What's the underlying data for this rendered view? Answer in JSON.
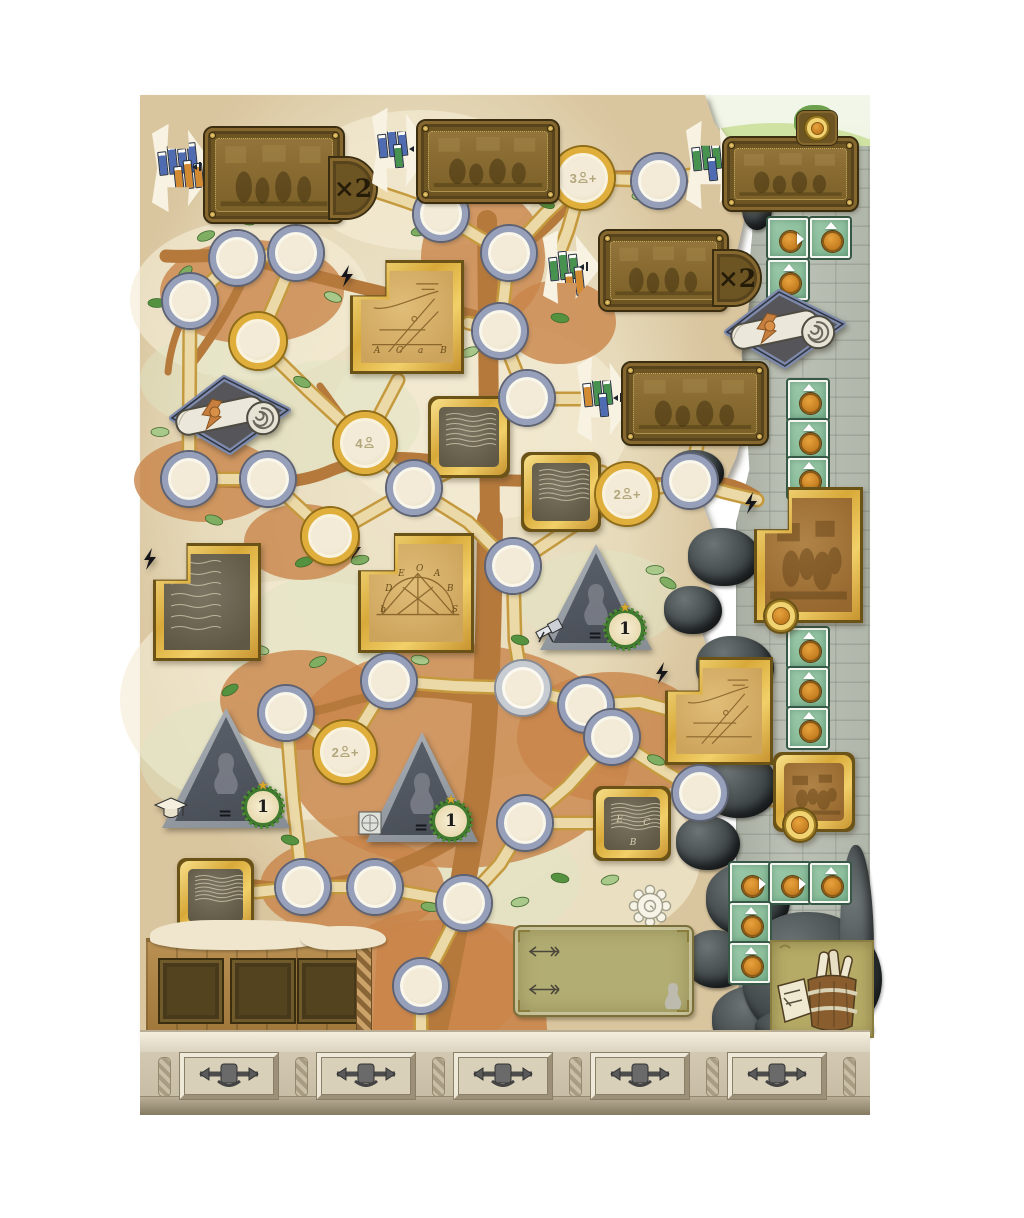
{
  "palette": {
    "parchment": "#e9dfc3",
    "path_fill": "#ecd9a8",
    "path_edge": "#c59a3f",
    "branch": "#b5793c",
    "dirt": "#c9854a",
    "node_rim_blue": "#97a0ba",
    "node_rim_gold": "#e0ae3b",
    "track_green": "#8cc19e",
    "coin_orange": "#d08a2e",
    "book_blue": "#4f6cb2",
    "book_orange": "#d28a33",
    "book_green": "#46924e",
    "plaque_brown": "#6d5423",
    "stone_light": "#b5bab0",
    "stone_dark": "#33393b",
    "triangle_gray": "#9aa0a6",
    "badge_green": "#3f7a2e"
  },
  "banners": [
    {
      "name": "bookshop-banner-1",
      "flag": {
        "x": 152,
        "y": 120,
        "w": 64,
        "h": 96
      },
      "stacks": [
        [
          "blue",
          "blue",
          "blue",
          "blue"
        ],
        [
          "orange",
          "orange",
          "orange"
        ]
      ],
      "plaque": {
        "x": 205,
        "y": 128,
        "w": 132,
        "h": 88
      },
      "multiplier": "×2",
      "mult_box": {
        "x": 330,
        "y": 158,
        "w": 40,
        "h": 54
      }
    },
    {
      "name": "bookshop-banner-2",
      "flag": {
        "x": 372,
        "y": 104,
        "w": 60,
        "h": 92
      },
      "stacks": [
        [
          "blue",
          "blue",
          "blue"
        ],
        [
          "green"
        ]
      ],
      "plaque": {
        "x": 418,
        "y": 121,
        "w": 134,
        "h": 75
      }
    },
    {
      "name": "bookshop-banner-3",
      "flag": {
        "x": 686,
        "y": 117,
        "w": 60,
        "h": 96
      },
      "stacks": [
        [
          "green",
          "green",
          "green"
        ],
        [
          "blue"
        ]
      ],
      "plaque": {
        "x": 724,
        "y": 138,
        "w": 127,
        "h": 66
      },
      "top_medallion": {
        "x": 797,
        "y": 111,
        "w": 36,
        "h": 30
      }
    },
    {
      "name": "bookshop-banner-4",
      "flag": {
        "x": 543,
        "y": 227,
        "w": 58,
        "h": 80
      },
      "stacks": [
        [
          "green",
          "green",
          "green"
        ],
        [
          "orange",
          "orange"
        ]
      ],
      "plaque": {
        "x": 600,
        "y": 231,
        "w": 121,
        "h": 73
      },
      "multiplier": "×2",
      "mult_box": {
        "x": 714,
        "y": 251,
        "w": 40,
        "h": 48
      }
    },
    {
      "name": "bookshop-banner-5",
      "flag": {
        "x": 577,
        "y": 353,
        "w": 58,
        "h": 92
      },
      "stacks": [
        [
          "orange",
          "green",
          "green"
        ],
        [
          "blue"
        ]
      ],
      "plaque": {
        "x": 623,
        "y": 363,
        "w": 138,
        "h": 75
      }
    }
  ],
  "nodes": [
    {
      "x": 441,
      "y": 214,
      "rim": "blue",
      "count": "",
      "suffix": ""
    },
    {
      "x": 509,
      "y": 253,
      "rim": "blue",
      "count": "",
      "suffix": ""
    },
    {
      "x": 583,
      "y": 178,
      "rim": "gold",
      "count": "3",
      "suffix": "+"
    },
    {
      "x": 659,
      "y": 181,
      "rim": "blue",
      "count": "",
      "suffix": ""
    },
    {
      "x": 237,
      "y": 258,
      "rim": "blue",
      "count": "",
      "suffix": ""
    },
    {
      "x": 296,
      "y": 253,
      "rim": "blue",
      "count": "",
      "suffix": ""
    },
    {
      "x": 190,
      "y": 301,
      "rim": "blue",
      "count": "",
      "suffix": ""
    },
    {
      "x": 258,
      "y": 341,
      "rim": "gold",
      "count": "",
      "suffix": ""
    },
    {
      "x": 500,
      "y": 331,
      "rim": "blue",
      "count": "",
      "suffix": ""
    },
    {
      "x": 527,
      "y": 398,
      "rim": "blue",
      "count": "",
      "suffix": ""
    },
    {
      "x": 365,
      "y": 443,
      "rim": "gold",
      "count": "4",
      "suffix": ""
    },
    {
      "x": 189,
      "y": 479,
      "rim": "blue",
      "count": "",
      "suffix": ""
    },
    {
      "x": 268,
      "y": 479,
      "rim": "blue",
      "count": "",
      "suffix": ""
    },
    {
      "x": 414,
      "y": 488,
      "rim": "blue",
      "count": "",
      "suffix": ""
    },
    {
      "x": 627,
      "y": 494,
      "rim": "gold",
      "count": "2",
      "suffix": "+"
    },
    {
      "x": 690,
      "y": 481,
      "rim": "blue",
      "count": "",
      "suffix": ""
    },
    {
      "x": 330,
      "y": 536,
      "rim": "gold",
      "count": "",
      "suffix": ""
    },
    {
      "x": 513,
      "y": 566,
      "rim": "blue",
      "count": "",
      "suffix": ""
    },
    {
      "x": 286,
      "y": 713,
      "rim": "blue",
      "count": "",
      "suffix": ""
    },
    {
      "x": 389,
      "y": 681,
      "rim": "blue",
      "count": "",
      "suffix": ""
    },
    {
      "x": 523,
      "y": 688,
      "rim": "silver",
      "count": "",
      "suffix": ""
    },
    {
      "x": 586,
      "y": 705,
      "rim": "blue",
      "count": "",
      "suffix": ""
    },
    {
      "x": 612,
      "y": 737,
      "rim": "blue",
      "count": "",
      "suffix": ""
    },
    {
      "x": 345,
      "y": 752,
      "rim": "gold",
      "count": "2",
      "suffix": "+"
    },
    {
      "x": 700,
      "y": 793,
      "rim": "blue",
      "count": "",
      "suffix": ""
    },
    {
      "x": 525,
      "y": 823,
      "rim": "blue",
      "count": "",
      "suffix": ""
    },
    {
      "x": 303,
      "y": 887,
      "rim": "blue",
      "count": "",
      "suffix": ""
    },
    {
      "x": 375,
      "y": 887,
      "rim": "blue",
      "count": "",
      "suffix": ""
    },
    {
      "x": 464,
      "y": 903,
      "rim": "blue",
      "count": "",
      "suffix": ""
    },
    {
      "x": 421,
      "y": 986,
      "rim": "blue",
      "count": "",
      "suffix": ""
    }
  ],
  "tiles": [
    {
      "kind": "sketch",
      "x": 353,
      "y": 263,
      "w": 108,
      "h": 108,
      "notch": true,
      "bolt": true,
      "letters": [
        "A",
        "C",
        "a",
        "B"
      ],
      "layout": "row"
    },
    {
      "kind": "sketch",
      "x": 361,
      "y": 536,
      "w": 110,
      "h": 114,
      "notch": true,
      "bolt": true,
      "letters": [
        "b",
        "D",
        "E",
        "O",
        "A",
        "B",
        "S"
      ],
      "layout": "arc"
    },
    {
      "kind": "manuscript",
      "x": 156,
      "y": 546,
      "w": 102,
      "h": 112,
      "notch": true,
      "bolt": true,
      "letters": [],
      "layout": "row"
    },
    {
      "kind": "manuscript",
      "x": 431,
      "y": 399,
      "w": 76,
      "h": 76,
      "letters": [],
      "layout": "row"
    },
    {
      "kind": "manuscript",
      "x": 524,
      "y": 455,
      "w": 74,
      "h": 74,
      "letters": [],
      "layout": "row"
    },
    {
      "kind": "manuscript",
      "x": 596,
      "y": 789,
      "w": 72,
      "h": 69,
      "letters": [
        "E",
        "C",
        "B"
      ],
      "layout": "scatter"
    },
    {
      "kind": "manuscript",
      "x": 180,
      "y": 861,
      "w": 71,
      "h": 69,
      "letters": [],
      "layout": "row"
    },
    {
      "kind": "sketch",
      "x": 668,
      "y": 660,
      "w": 102,
      "h": 102,
      "notch": true,
      "bolt": true,
      "letters": [],
      "layout": "row"
    },
    {
      "kind": "engraving",
      "x": 757,
      "y": 490,
      "w": 103,
      "h": 130,
      "notch": true,
      "bolt": true,
      "coin": true,
      "letters": [],
      "layout": "row"
    },
    {
      "kind": "engraving",
      "x": 776,
      "y": 755,
      "w": 76,
      "h": 74,
      "coin": true,
      "letters": [],
      "layout": "row"
    }
  ],
  "scrolls": [
    {
      "x": 163,
      "y": 368,
      "w": 132,
      "h": 92
    },
    {
      "x": 718,
      "y": 282,
      "w": 132,
      "h": 92
    }
  ],
  "triangles": [
    {
      "x": 162,
      "y": 708,
      "w": 128,
      "h": 120,
      "icon": "mortarboard-icon",
      "equals": "=",
      "badge": "1"
    },
    {
      "x": 366,
      "y": 732,
      "w": 112,
      "h": 110,
      "icon": "seal-icon",
      "equals": "=",
      "badge": "1"
    },
    {
      "x": 540,
      "y": 544,
      "w": 112,
      "h": 106,
      "icon": "telescope-icon",
      "equals": "=",
      "badge": "1"
    }
  ],
  "track": {
    "coin_icon": "coin-icon",
    "tiles": [
      {
        "x": 768,
        "y": 218,
        "arrow": "right"
      },
      {
        "x": 810,
        "y": 218,
        "arrow": "up"
      },
      {
        "x": 768,
        "y": 260,
        "arrow": "up"
      },
      {
        "x": 788,
        "y": 380,
        "arrow": "up"
      },
      {
        "x": 788,
        "y": 420,
        "arrow": "up"
      },
      {
        "x": 788,
        "y": 458,
        "arrow": "up"
      },
      {
        "x": 788,
        "y": 628,
        "arrow": "up"
      },
      {
        "x": 788,
        "y": 668,
        "arrow": "up"
      },
      {
        "x": 788,
        "y": 708,
        "arrow": "up"
      },
      {
        "x": 730,
        "y": 863,
        "arrow": "right"
      },
      {
        "x": 770,
        "y": 863,
        "arrow": "right"
      },
      {
        "x": 810,
        "y": 863,
        "arrow": "up"
      },
      {
        "x": 730,
        "y": 903,
        "arrow": "up"
      },
      {
        "x": 730,
        "y": 943,
        "arrow": "up"
      }
    ]
  },
  "bottom": {
    "crate_slots": 3,
    "note": {
      "arrow_icon": "feather-arrow-icon",
      "arrow_count": 2,
      "bust_icon": "bust-icon"
    },
    "gear_icon": "gear-sketch-icon",
    "barrel_icon": "barrel-of-scrolls-icon"
  },
  "frieze": {
    "panel_count": 5,
    "ornament_icon": "metal-scrollwork-icon"
  }
}
